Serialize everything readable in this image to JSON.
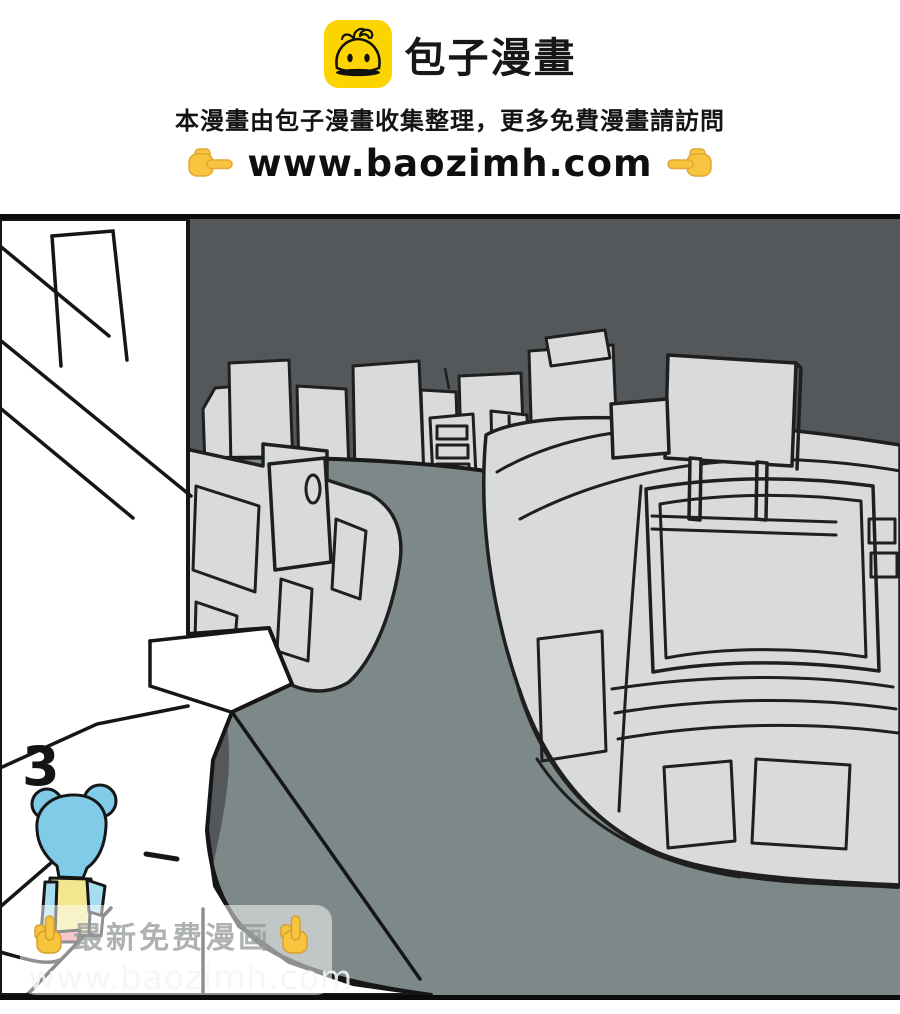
{
  "header": {
    "brand": {
      "name": "包子漫畫",
      "icon": "bun-logo-icon",
      "icon_bg_color": "#fcd500"
    },
    "notice": "本漫畫由包子漫畫收集整理，更多免費漫畫請訪問",
    "url": "www.baozimh.com",
    "left_icon": "pointing-right-icon",
    "right_icon": "pointing-left-icon"
  },
  "comic_panel": {
    "page_number": "3",
    "colors": {
      "sky": "#54585b",
      "road": "#7d8888",
      "building_fill": "#d8dadb",
      "outline": "#1c1c1c",
      "foreground_structure": "#ffffff",
      "character_head": "#7fcbe8",
      "character_shirt": "#f2e78e",
      "character_sleeves": "#a5dcef",
      "character_shorts": "#ef8b95"
    }
  },
  "watermark": {
    "title": "最新免费漫画",
    "url": "www.baozimh.com",
    "left_icon": "pointing-up-icon",
    "right_icon": "pointing-up-icon"
  }
}
